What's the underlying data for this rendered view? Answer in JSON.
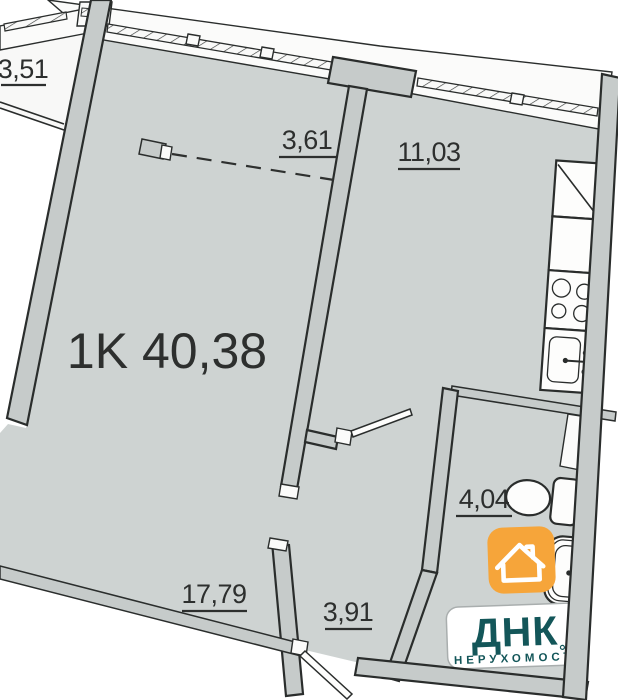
{
  "plan": {
    "title": "1K 40,38",
    "rooms": {
      "balcony": "3,51",
      "wardrobe": "3,61",
      "kitchen": "11,03",
      "bathroom": "4,04",
      "living": "17,79",
      "hallway": "3,91"
    }
  },
  "branding": {
    "name": "ДНК",
    "tagline": "НЕРУХОМОСТІ",
    "icon": "house-icon",
    "colors": {
      "orange": "#F6A53A",
      "teal": "#135659"
    }
  },
  "colors": {
    "floor": "#ced3d2",
    "wall": "#c6cbca",
    "outline": "#2a2d2c",
    "window": "#f9f9f8"
  }
}
